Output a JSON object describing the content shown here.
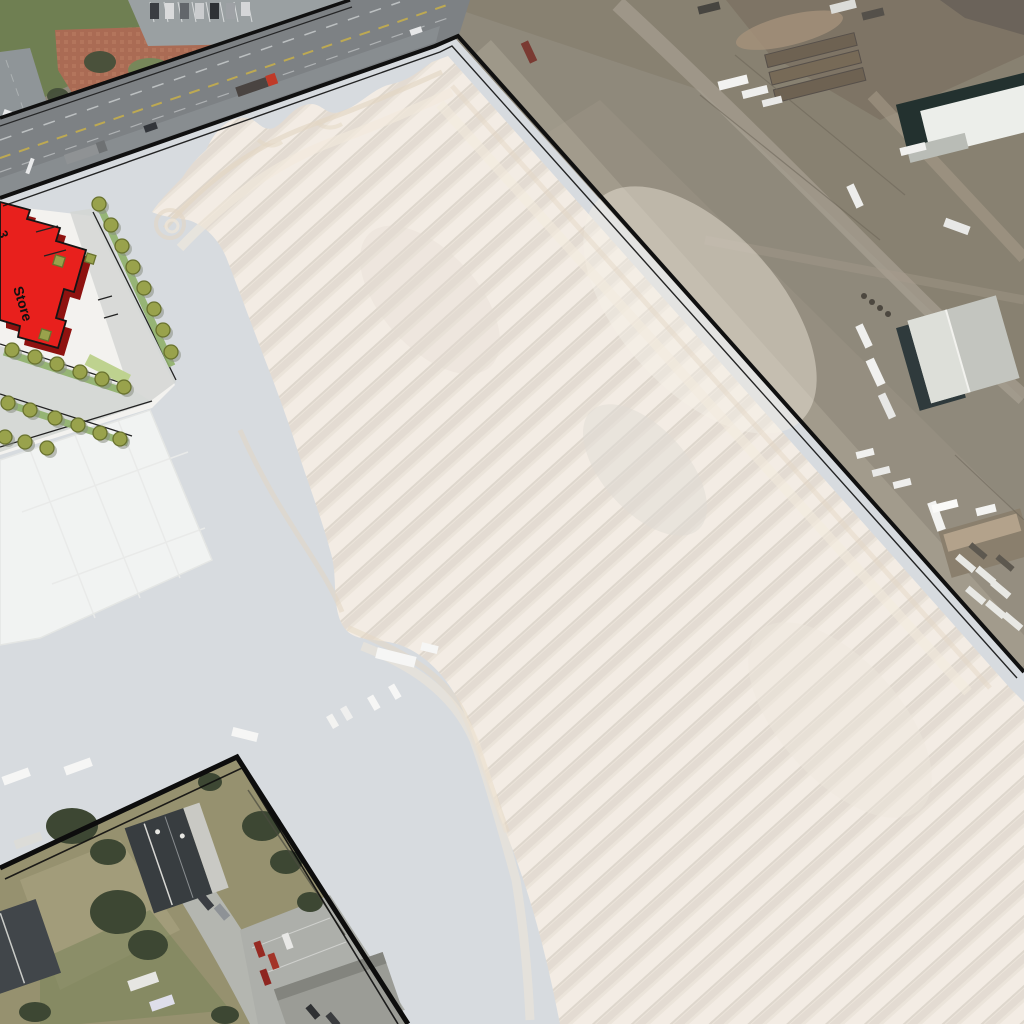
{
  "scene": {
    "description": "Aerial map with highlighted development parcel and pasted site-plan overlay",
    "store_label": "Store",
    "store_partial_label": "3"
  },
  "overlay": {
    "parcel_highlight_color": "#ffffff",
    "parcel_highlight_opacity": "0.32",
    "boundary_color": "#101010"
  },
  "site_plan": {
    "paper_fill": "#f3f2ef",
    "store_fill": "#e8201d",
    "store_side_fill": "#8f1210",
    "tree_fill": "#99a24c",
    "tree_stroke": "#69722f",
    "hedge_fill": "#bed28f",
    "aisle_fill": "#d6d9d6"
  },
  "aerial": {
    "field_base": "#e2d7c9",
    "field_stripe_light": "#eee4d7",
    "field_stripe_dark": "#d6cbbd",
    "grading_band": "#d6c3a8",
    "parcel_pavement": "#c4cad0",
    "slab_fill": "#ebeeec",
    "industrial_dirt": "#8f897b",
    "park_grass": "#6f7f52",
    "plaza_brick": "#aa6b54",
    "highway_asphalt": "#7d8184",
    "excluded_lawn": "#96916f",
    "dark_roof": "#383d40",
    "warehouse_roof": "#cdcfc9"
  },
  "vehicles": {
    "highway_truck_cab": "#c03a28",
    "red_car": "#962a22",
    "white_vehicle": "#f2f2f0"
  }
}
